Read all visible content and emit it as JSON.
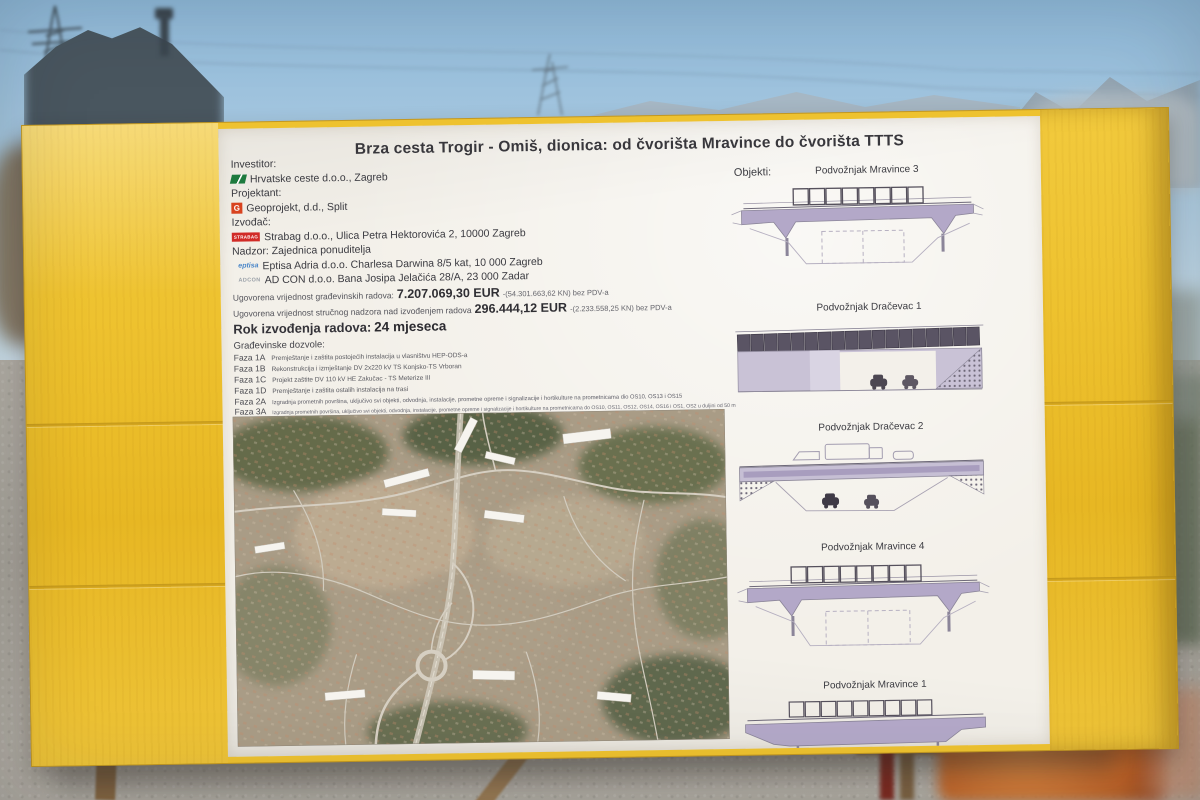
{
  "board": {
    "title": "Brza cesta Trogir - Omiš, dionica: od čvorišta Mravince do čvorišta TTTS",
    "parties": [
      {
        "role": "Investitor:",
        "name": "Hrvatske ceste d.o.o., Zagreb",
        "logo": "hrvatske-ceste-logo"
      },
      {
        "role": "Projektant:",
        "name": "Geoprojekt, d.d., Split",
        "logo": "geoprojekt-logo"
      },
      {
        "role": "Izvođač:",
        "name": "Strabag d.o.o., Ulica Petra Hektorovića 2, 10000 Zagreb",
        "logo": "strabag-logo"
      }
    ],
    "nadzor": {
      "label": "Nadzor: Zajednica ponuditelja",
      "members": [
        {
          "name": "Eptisa Adria d.o.o. Charlesa Darwina 8/5 kat, 10 000 Zagreb",
          "logo": "eptisa-logo"
        },
        {
          "name": "AD CON d.o.o. Bana Josipa Jelačića 28/A, 23 000 Zadar",
          "logo": "adcon-logo"
        }
      ]
    },
    "values": [
      {
        "label": "Ugovorena vrijednost građevinskih radova:",
        "value": "7.207.069,30 EUR",
        "suffix": "-(54.301.663,62 KN) bez PDV-a"
      },
      {
        "label": "Ugovorena vrijednost stručnog nadzora nad izvođenjem radova",
        "value": "296.444,12 EUR",
        "suffix": "-(2.233.558,25 KN) bez PDV-a"
      }
    ],
    "rok": {
      "label": "Rok izvođenja radova:",
      "value": "24 mjeseca"
    },
    "dozvole_label": "Građevinske dozvole:",
    "faze": [
      {
        "code": "Faza 1A",
        "text": "Premještanje i zaštita postojećih instalacija u vlasništvu HEP-ODS-a"
      },
      {
        "code": "Faza 1B",
        "text": "Rekonstrukcija i izmještanje DV 2x220 kV TS Konjsko-TS Vrboran"
      },
      {
        "code": "Faza 1C",
        "text": "Projekt zaštite DV 110 kV HE Zakučac - TS Meterize III"
      },
      {
        "code": "Faza 1D",
        "text": "Premještanje i zaštita ostalih instalacija na trasi"
      },
      {
        "code": "Faza 2A",
        "text": "Izgradnja prometnih površina, uključivo svi objekti, odvodnja, instalacije, prometne opreme i signalizacije i hortikulture na prometnicama dio OS10, OS13 i OS15"
      },
      {
        "code": "Faza 3A",
        "text": "Izgradnja prometnih površina, uključivo svi objekti, odvodnja, instalacije, prometne opreme i signalizacije i hortikulture na prometnicama do OS10, OS11, OS12, OS14, OS16 i OS1, OS2 u duljini od 50 m"
      }
    ],
    "objekti_label": "Objekti:",
    "objekti": [
      "Podvožnjak Mravince 3",
      "Podvožnjak Dračevac 1",
      "Podvožnjak Dračevac 2",
      "Podvožnjak Mravince 4",
      "Podvožnjak Mravince 1"
    ],
    "logo_texts": {
      "geoprojekt": "G",
      "strabag": "STRABAG",
      "eptisa": "eptisa",
      "adcon": "ADCON"
    }
  },
  "colors": {
    "frame_yellow": "#eec22f",
    "paper": "#f3f0e9",
    "deck_purple": "#b3a8c8",
    "strabag_red": "#d12b27",
    "hrvatske_ceste_green": "#1d7a3e"
  }
}
